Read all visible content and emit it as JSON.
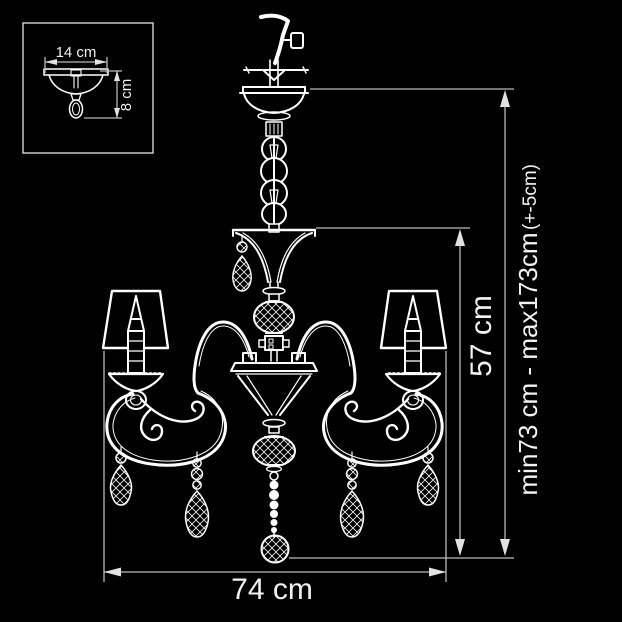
{
  "title": "Chandelier technical drawing",
  "inset": {
    "width_label": "14 cm",
    "height_label": "8 cm"
  },
  "dimensions": {
    "body_height_label": "57 cm",
    "hanging_range_label": "min73 cm - max173cm",
    "hanging_tolerance_label": "(+-5cm)",
    "width_label": "74 cm"
  },
  "colors": {
    "background": "#000000",
    "drawing_line": "#ffffff",
    "dimension_line": "#b9b9b9",
    "dimension_text": "#f2f2f2"
  }
}
